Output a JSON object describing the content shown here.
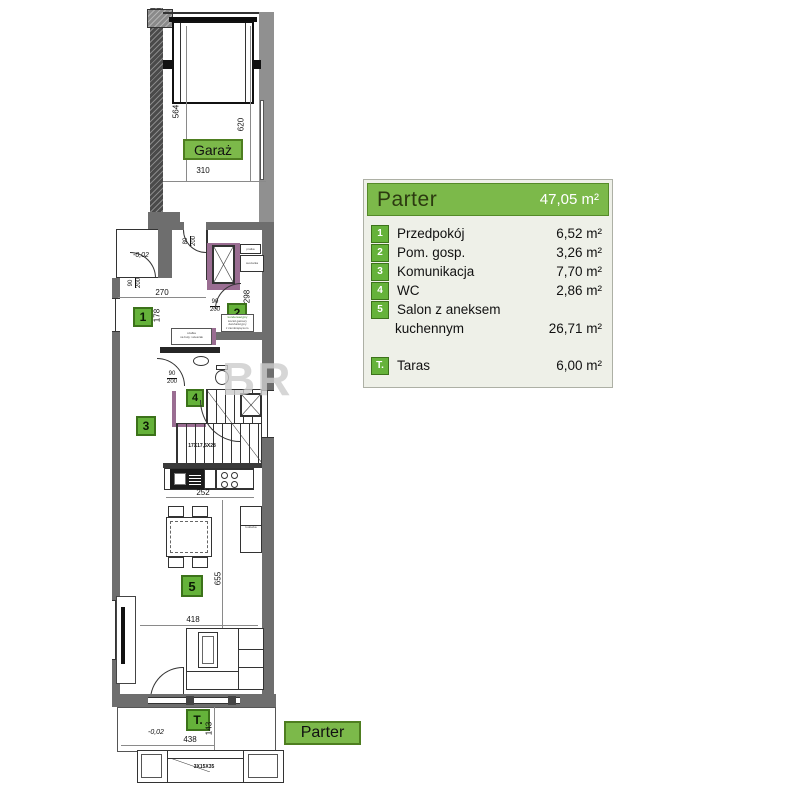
{
  "legend": {
    "title": "Parter",
    "total_area": "47,05 m²",
    "items": [
      {
        "badge": "1",
        "name": "Przedpokój",
        "area": "6,52 m²"
      },
      {
        "badge": "2",
        "name": "Pom. gosp.",
        "area": "3,26 m²"
      },
      {
        "badge": "3",
        "name": "Komunikacja",
        "area": "7,70 m²"
      },
      {
        "badge": "4",
        "name": "WC",
        "area": "2,86 m²"
      },
      {
        "badge": "5",
        "name": "Salon z aneksem",
        "name_line2": "kuchennym",
        "area": "26,71 m²"
      },
      {
        "badge": "T.",
        "name": "Taras",
        "area": "6,00 m²"
      }
    ]
  },
  "plan": {
    "room_labels": {
      "garage": "Garaż",
      "floor": "Parter"
    },
    "badges": {
      "r1": "1",
      "r2": "2",
      "r3": "3",
      "r4": "4",
      "r5": "5",
      "taras": "T."
    },
    "dims": {
      "garage_depth_left": "564",
      "garage_depth_right": "620",
      "garage_width": "310",
      "hall_width": "270",
      "hall_depth": "178",
      "utility_depth": "298",
      "kitchen_width": "252",
      "living_depth": "655",
      "living_width": "418",
      "terrace_width": "438",
      "terrace_depth": "143",
      "stairs_spec": "17X17,5X28",
      "outdoor_steps_spec": "3X15X35",
      "level_entrance": "-0,02",
      "level_terrace": "-0,02"
    },
    "door_dims": {
      "entrance": {
        "w": "90",
        "h": "200"
      },
      "hall_top": {
        "w": "80",
        "h": "200"
      },
      "utility": {
        "w": "90",
        "h": "200"
      },
      "wc": {
        "w": "90",
        "h": "200"
      }
    },
    "equipment_labels": {
      "washer": "pralka",
      "dryer": "suszarka",
      "fridge": "lodówka",
      "boiler_line1": "kondensacyjny",
      "boiler_line2": "kocioł gazowy",
      "boiler_line3": "dwufunkcyjny",
      "boiler_line4": "z zamkniętą kom.",
      "cabinet_line1": "szafka",
      "cabinet_line2": "na buty i wieszak"
    },
    "watermark": "BR"
  },
  "colors": {
    "green": "#7cb94a",
    "green_dark": "#4e7e20",
    "badge_green": "#65b23a",
    "accent_purple": "#9a6d92",
    "wall_gray": "#6e6e6e",
    "legend_bg": "#eef0e8"
  }
}
